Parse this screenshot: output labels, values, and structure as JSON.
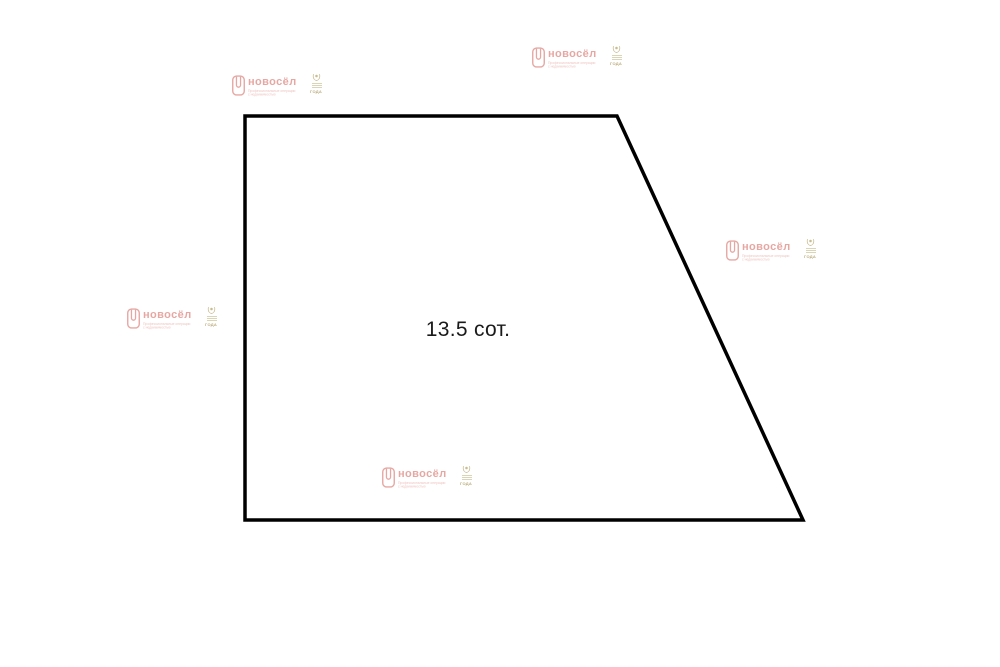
{
  "plot": {
    "area_label": "13.5 сот.",
    "outline_color": "#000000",
    "outline_width": 3.5,
    "vertices": [
      [
        245,
        116
      ],
      [
        617,
        116
      ],
      [
        803,
        520
      ],
      [
        245,
        520
      ]
    ],
    "background": "#ffffff"
  },
  "watermark": {
    "brand": "новосёл",
    "tagline_line1": "Профессиональные операции",
    "tagline_line2": "с недвижимостью",
    "badge_year": "ГОДА",
    "brand_color": "#e49e99",
    "tagline_color": "#ecbcb8",
    "badge_color": "#c3b584",
    "house_icon": "house-door-icon",
    "badge_icon": "laurel-emblem-icon",
    "count": 5
  }
}
